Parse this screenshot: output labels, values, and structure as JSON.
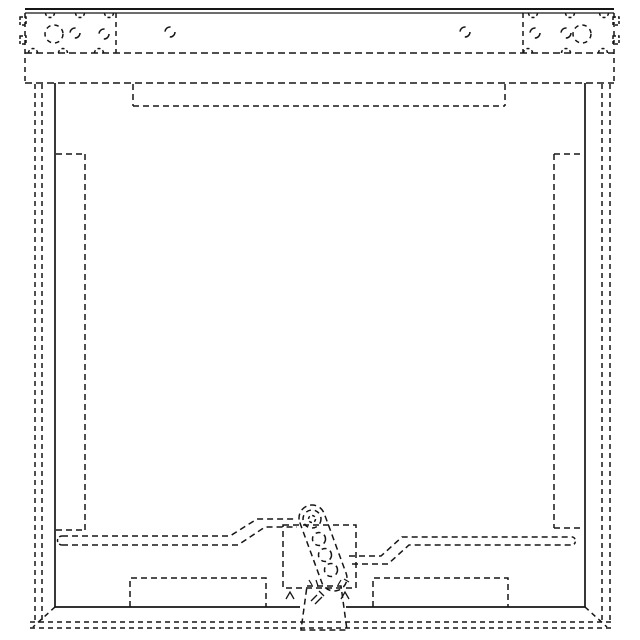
{
  "drawing": {
    "canvas": {
      "width": 640,
      "height": 640,
      "background": "#ffffff",
      "stroke": "#161616",
      "default_stroke_width": 1.5
    },
    "shapes": [
      {
        "name": "top-edge-outer",
        "type": "line",
        "x1": 25,
        "y1": 9,
        "x2": 614,
        "y2": 9,
        "w": 1.9
      },
      {
        "name": "top-edge-inner",
        "type": "line",
        "x1": 25,
        "y1": 13,
        "x2": 614,
        "y2": 13,
        "w": 1.3
      },
      {
        "name": "top-bar-left-edge",
        "type": "line",
        "x1": 25,
        "y1": 13,
        "x2": 25,
        "y2": 83,
        "dash": "5,4"
      },
      {
        "name": "top-bar-right-edge",
        "type": "line",
        "x1": 614,
        "y1": 13,
        "x2": 614,
        "y2": 83,
        "dash": "5,4"
      },
      {
        "name": "top-bar-seam",
        "type": "line",
        "x1": 25,
        "y1": 53,
        "x2": 614,
        "y2": 53,
        "dash": "7,4"
      },
      {
        "name": "top-bar-bottom-edge",
        "type": "line",
        "x1": 25,
        "y1": 83,
        "x2": 614,
        "y2": 83,
        "dash": "7,4"
      },
      {
        "name": "left-corner-bracket-edge",
        "type": "line",
        "x1": 116,
        "y1": 13,
        "x2": 116,
        "y2": 53,
        "dash": "5,4"
      },
      {
        "name": "right-corner-bracket-edge",
        "type": "line",
        "x1": 523,
        "y1": 13,
        "x2": 523,
        "y2": 53,
        "dash": "5,4"
      },
      {
        "name": "left-bracket-tab-upper",
        "type": "rect",
        "x": 20,
        "y": 17,
        "wd": 6,
        "h": 8,
        "dash": "3,2"
      },
      {
        "name": "left-bracket-tab-lower",
        "type": "rect",
        "x": 20,
        "y": 36,
        "wd": 6,
        "h": 8,
        "dash": "3,2"
      },
      {
        "name": "right-bracket-tab-upper",
        "type": "rect",
        "x": 613,
        "y": 17,
        "wd": 6,
        "h": 8,
        "dash": "3,2"
      },
      {
        "name": "right-bracket-tab-lower",
        "type": "rect",
        "x": 613,
        "y": 36,
        "wd": 6,
        "h": 8,
        "dash": "3,2"
      },
      {
        "name": "left-bracket-pilot-hole",
        "type": "circle",
        "cx": 54,
        "cy": 34,
        "r": 9,
        "dash": "4.5,4"
      },
      {
        "name": "right-bracket-pilot-hole",
        "type": "circle",
        "cx": 582,
        "cy": 34,
        "r": 9,
        "dash": "4.5,4"
      },
      {
        "name": "left-bracket-hole-a",
        "type": "circle",
        "cx": 75,
        "cy": 33,
        "r": 5,
        "dash": "8,8"
      },
      {
        "name": "left-bracket-hole-b",
        "type": "circle",
        "cx": 104,
        "cy": 34,
        "r": 5,
        "dash": "8,8"
      },
      {
        "name": "top-rail-hole-left",
        "type": "circle",
        "cx": 170,
        "cy": 32,
        "r": 5,
        "dash": "8,8"
      },
      {
        "name": "top-rail-hole-right",
        "type": "circle",
        "cx": 465,
        "cy": 32,
        "r": 5,
        "dash": "8,8"
      },
      {
        "name": "right-bracket-hole-a",
        "type": "circle",
        "cx": 535,
        "cy": 33,
        "r": 5,
        "dash": "8,8"
      },
      {
        "name": "right-bracket-hole-b",
        "type": "circle",
        "cx": 566,
        "cy": 33,
        "r": 5,
        "dash": "8,8"
      },
      {
        "name": "top-seam-notch-1",
        "type": "path",
        "d": "M45.5,13 A4.5,4.5 0 0 0 54.5,13",
        "dash": "3,2.5"
      },
      {
        "name": "top-seam-notch-2",
        "type": "path",
        "d": "M75.5,13 A4.5,4.5 0 0 0 84.5,13",
        "dash": "3,2.5"
      },
      {
        "name": "top-seam-notch-3",
        "type": "path",
        "d": "M104.5,13 A4.5,4.5 0 0 0 113.5,13",
        "dash": "3,2.5"
      },
      {
        "name": "top-seam-notch-4",
        "type": "path",
        "d": "M528.5,13 A4.5,4.5 0 0 0 537.5,13",
        "dash": "3,2.5"
      },
      {
        "name": "top-seam-notch-5",
        "type": "path",
        "d": "M565.5,13 A4.5,4.5 0 0 0 574.5,13",
        "dash": "3,2.5"
      },
      {
        "name": "top-seam-notch-6",
        "type": "path",
        "d": "M599.5,13 A4.5,4.5 0 0 0 608.5,13",
        "dash": "3,2.5"
      },
      {
        "name": "bottom-seam-notch-1",
        "type": "path",
        "d": "M28.5,53 A4.5,4.5 0 0 1 37.5,53",
        "dash": "3,2.5"
      },
      {
        "name": "bottom-seam-notch-2",
        "type": "path",
        "d": "M58.5,53 A4.5,4.5 0 0 1 67.5,53",
        "dash": "3,2.5"
      },
      {
        "name": "bottom-seam-notch-3",
        "type": "path",
        "d": "M94.5,53 A4.5,4.5 0 0 1 103.5,53",
        "dash": "3,2.5"
      },
      {
        "name": "bottom-seam-notch-4",
        "type": "path",
        "d": "M523.5,53 A4.5,4.5 0 0 1 532.5,53",
        "dash": "3,2.5"
      },
      {
        "name": "bottom-seam-notch-5",
        "type": "path",
        "d": "M561.5,53 A4.5,4.5 0 0 1 570.5,53",
        "dash": "3,2.5"
      },
      {
        "name": "bottom-seam-notch-6",
        "type": "path",
        "d": "M598.5,53 A4.5,4.5 0 0 1 607.5,53",
        "dash": "3,2.5"
      },
      {
        "name": "frame-left-edge",
        "type": "line",
        "x1": 55,
        "y1": 83,
        "x2": 55,
        "y2": 607,
        "w": 1.7
      },
      {
        "name": "frame-right-edge",
        "type": "line",
        "x1": 585,
        "y1": 83,
        "x2": 585,
        "y2": 607,
        "w": 1.7
      },
      {
        "name": "frame-bottom-edge-left",
        "type": "line",
        "x1": 55,
        "y1": 607,
        "x2": 300,
        "y2": 607,
        "w": 1.7
      },
      {
        "name": "frame-bottom-edge-right",
        "type": "line",
        "x1": 346,
        "y1": 607,
        "x2": 585,
        "y2": 607,
        "w": 1.7
      },
      {
        "name": "outer-left-line-a",
        "type": "line",
        "x1": 35,
        "y1": 84,
        "x2": 35,
        "y2": 622,
        "dash": "5,4"
      },
      {
        "name": "outer-left-line-b",
        "type": "line",
        "x1": 42,
        "y1": 84,
        "x2": 42,
        "y2": 622,
        "dash": "5,4"
      },
      {
        "name": "outer-right-line-a",
        "type": "line",
        "x1": 602,
        "y1": 84,
        "x2": 602,
        "y2": 622,
        "dash": "5,4"
      },
      {
        "name": "outer-right-line-b",
        "type": "line",
        "x1": 610,
        "y1": 84,
        "x2": 610,
        "y2": 622,
        "dash": "5,4"
      },
      {
        "name": "outer-bottom-line-a",
        "type": "line",
        "x1": 30,
        "y1": 622,
        "x2": 611,
        "y2": 622,
        "dash": "5,4"
      },
      {
        "name": "outer-bottom-line-b",
        "type": "line",
        "x1": 30,
        "y1": 628,
        "x2": 611,
        "y2": 628,
        "dash": "5,4"
      },
      {
        "name": "bottom-left-miter",
        "type": "line",
        "x1": 55,
        "y1": 607,
        "x2": 33,
        "y2": 627,
        "dash": "5,4"
      },
      {
        "name": "bottom-right-miter",
        "type": "line",
        "x1": 585,
        "y1": 607,
        "x2": 607,
        "y2": 627,
        "dash": "5,4"
      },
      {
        "name": "top-panel-left-edge",
        "type": "line",
        "x1": 133,
        "y1": 84,
        "x2": 133,
        "y2": 106,
        "dash": "6,4"
      },
      {
        "name": "top-panel-bottom-edge",
        "type": "line",
        "x1": 133,
        "y1": 106,
        "x2": 505,
        "y2": 106,
        "dash": "6,4"
      },
      {
        "name": "top-panel-right-edge",
        "type": "line",
        "x1": 505,
        "y1": 84,
        "x2": 505,
        "y2": 106,
        "dash": "6,4"
      },
      {
        "name": "left-slot-top",
        "type": "line",
        "x1": 56,
        "y1": 154,
        "x2": 85,
        "y2": 154,
        "dash": "6,4"
      },
      {
        "name": "left-slot-inner-edge",
        "type": "line",
        "x1": 85,
        "y1": 154,
        "x2": 85,
        "y2": 530,
        "dash": "6,4"
      },
      {
        "name": "left-slot-bottom",
        "type": "line",
        "x1": 56,
        "y1": 530,
        "x2": 85,
        "y2": 530,
        "dash": "6,4"
      },
      {
        "name": "right-slot-top",
        "type": "line",
        "x1": 554,
        "y1": 154,
        "x2": 584,
        "y2": 154,
        "dash": "6,4"
      },
      {
        "name": "right-slot-inner-edge",
        "type": "line",
        "x1": 554,
        "y1": 154,
        "x2": 554,
        "y2": 528,
        "dash": "6,4"
      },
      {
        "name": "right-slot-bottom",
        "type": "line",
        "x1": 554,
        "y1": 528,
        "x2": 584,
        "y2": 528,
        "dash": "6,4"
      },
      {
        "name": "left-rail-upper",
        "type": "polyline",
        "points": "62,536 230,536 257,519 296,519",
        "dash": "6,4"
      },
      {
        "name": "left-rail-lower",
        "type": "polyline",
        "points": "62,545 238,545 265,527 297,527",
        "dash": "6,4"
      },
      {
        "name": "left-rail-end-cap",
        "type": "path",
        "d": "M62,536 A4.5,4.5 0 0 0 62,545",
        "dash": "3,2.5"
      },
      {
        "name": "right-rail-upper",
        "type": "polyline",
        "points": "349,556 381,556 402,537 573,537",
        "dash": "6,4"
      },
      {
        "name": "right-rail-lower",
        "type": "polyline",
        "points": "352,564 388,564 409,545 573,545",
        "dash": "6,4"
      },
      {
        "name": "right-rail-end-cap",
        "type": "path",
        "d": "M573,537 A4.5,4.5 0 0 1 573,545",
        "dash": "3,2.5"
      },
      {
        "name": "latch-housing",
        "type": "rect",
        "x": 283,
        "y": 525,
        "wd": 73,
        "h": 63,
        "dash": "6,4"
      },
      {
        "name": "hinge-bracket",
        "type": "path",
        "d": "M307,586 L341,586 L347,630 L301,630 Z",
        "dash": "6,4"
      },
      {
        "name": "housing-foot-left",
        "type": "path",
        "d": "M286,599 L290,592 L294,599",
        "w": 1.3
      },
      {
        "name": "housing-foot-right",
        "type": "path",
        "d": "M341,599 L345,592 L349,599",
        "w": 1.3
      },
      {
        "name": "spring-tick-a",
        "type": "line",
        "x1": 311,
        "y1": 601,
        "x2": 317,
        "y2": 595,
        "w": 1.3
      },
      {
        "name": "spring-tick-b",
        "type": "line",
        "x1": 315,
        "y1": 604,
        "x2": 322,
        "y2": 597,
        "w": 1.3
      },
      {
        "name": "spring-tick-c",
        "type": "line",
        "x1": 319,
        "y1": 591,
        "x2": 324,
        "y2": 596,
        "w": 1.3
      },
      {
        "name": "hinge-arm-body",
        "type": "path",
        "d": "M299.8,522.5 L321.8,582.5 A13,13 0 0 0 346.2,573.5 L324.2,513.5 A13,13 0 0 0 299.8,522.5 Z",
        "dash": "6,4"
      },
      {
        "name": "arm-pivot-outer",
        "type": "circle",
        "cx": 312,
        "cy": 519,
        "r": 9,
        "dash": "5,4"
      },
      {
        "name": "arm-pivot-inner",
        "type": "circle",
        "cx": 312,
        "cy": 519,
        "r": 3.5,
        "dash": "3,2.5"
      },
      {
        "name": "arm-link-1",
        "type": "circle",
        "cx": 319,
        "cy": 539,
        "r": 6.5,
        "dash": "5,4"
      },
      {
        "name": "arm-link-2",
        "type": "circle",
        "cx": 325,
        "cy": 555,
        "r": 6.5,
        "dash": "5,4"
      },
      {
        "name": "arm-link-3",
        "type": "circle",
        "cx": 331,
        "cy": 570,
        "r": 6.5,
        "dash": "5,4"
      },
      {
        "name": "arm-end-tick-a",
        "type": "line",
        "x1": 312,
        "y1": 585,
        "x2": 309,
        "y2": 580,
        "w": 1.2
      },
      {
        "name": "arm-end-tick-b",
        "type": "line",
        "x1": 318,
        "y1": 586,
        "x2": 316,
        "y2": 580,
        "w": 1.2
      },
      {
        "name": "arm-end-tick-c",
        "type": "line",
        "x1": 338,
        "y1": 585,
        "x2": 341,
        "y2": 580,
        "w": 1.2
      },
      {
        "name": "arm-end-tick-d",
        "type": "line",
        "x1": 344,
        "y1": 579,
        "x2": 349,
        "y2": 582,
        "w": 1.2
      },
      {
        "name": "bottom-left-plate",
        "type": "path",
        "d": "M130,607 L130,578 L266,578 L266,607",
        "dash": "6,4"
      },
      {
        "name": "bottom-right-plate",
        "type": "path",
        "d": "M373,607 L373,578 L508,578 L508,607",
        "dash": "6,4"
      }
    ]
  }
}
